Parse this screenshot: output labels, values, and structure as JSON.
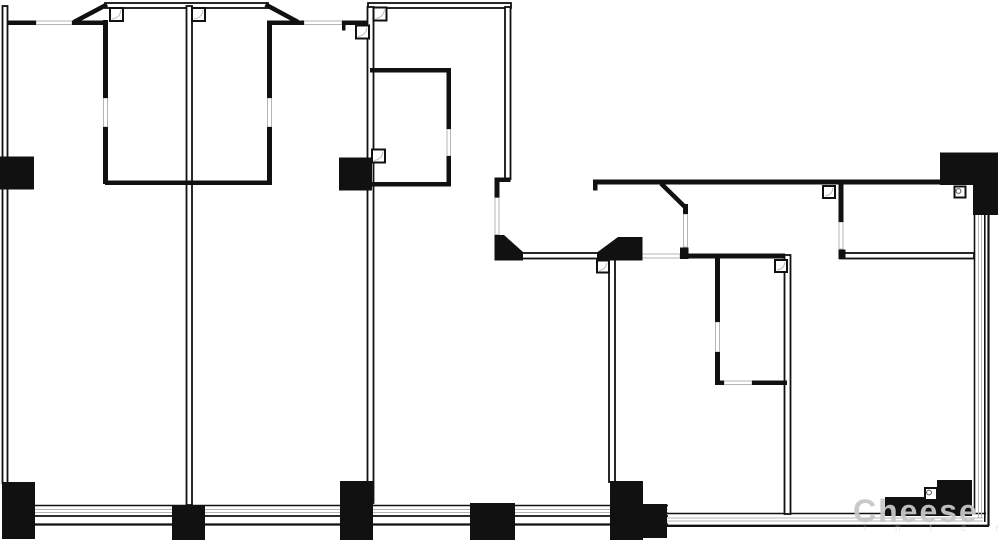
{
  "canvas": {
    "width": 1000,
    "height": 541,
    "background": "#ffffff"
  },
  "colors": {
    "wall": "#111111",
    "wall_core": "#ffffff",
    "opening": "#b5b5b5",
    "swing_arc": "#bbbbbb",
    "watermark": "#c7c7c7",
    "watermark_sub": "#d2d2d2"
  },
  "watermark": {
    "text": "Cheese",
    "sub_text": "i n t e r",
    "x": 853,
    "y": 522,
    "font_size": 32,
    "letter_spacing": 2,
    "opacity": 0.95,
    "sub_x": 864,
    "sub_y": 531,
    "sub_font_size": 10,
    "sub_letter_spacing": 13,
    "sub_opacity": 0.55
  },
  "plan": {
    "bands": [
      {
        "x1": 35,
        "y1": 505.5,
        "x2": 668,
        "y2": 505.5,
        "w": 1.6,
        "c": "wall"
      },
      {
        "x1": 35,
        "y1": 509.5,
        "x2": 668,
        "y2": 509.5,
        "w": 1.0,
        "c": "opening"
      },
      {
        "x1": 35,
        "y1": 512.5,
        "x2": 668,
        "y2": 512.5,
        "w": 1.0,
        "c": "opening"
      },
      {
        "x1": 35,
        "y1": 516.0,
        "x2": 668,
        "y2": 516.0,
        "w": 1.8,
        "c": "wall"
      },
      {
        "x1": 35,
        "y1": 524.5,
        "x2": 668,
        "y2": 524.5,
        "w": 2.2,
        "c": "wall"
      },
      {
        "x1": 667,
        "y1": 513.5,
        "x2": 986,
        "y2": 513.5,
        "w": 1.6,
        "c": "wall"
      },
      {
        "x1": 667,
        "y1": 518.0,
        "x2": 983,
        "y2": 518.0,
        "w": 1.0,
        "c": "opening"
      },
      {
        "x1": 667,
        "y1": 521.0,
        "x2": 983,
        "y2": 521.0,
        "w": 1.0,
        "c": "opening"
      },
      {
        "x1": 667,
        "y1": 525.8,
        "x2": 989,
        "y2": 525.8,
        "w": 2.4,
        "c": "wall"
      },
      {
        "x1": 974.5,
        "y1": 215,
        "x2": 974.5,
        "y2": 513,
        "w": 1.6,
        "c": "wall"
      },
      {
        "x1": 978.5,
        "y1": 215,
        "x2": 978.5,
        "y2": 518,
        "w": 1.0,
        "c": "opening"
      },
      {
        "x1": 981.5,
        "y1": 215,
        "x2": 981.5,
        "y2": 518,
        "w": 1.0,
        "c": "opening"
      },
      {
        "x1": 984.8,
        "y1": 215,
        "x2": 984.8,
        "y2": 522,
        "w": 1.6,
        "c": "wall"
      },
      {
        "x1": 988.5,
        "y1": 215,
        "x2": 988.5,
        "y2": 526,
        "w": 2.2,
        "c": "wall"
      }
    ],
    "hollow_walls": [
      {
        "x": 2.5,
        "y": 6,
        "w": 5,
        "h": 477
      },
      {
        "x": 105,
        "y": 3,
        "w": 163,
        "h": 5
      },
      {
        "x": 368,
        "y": 3,
        "w": 143,
        "h": 5
      },
      {
        "x": 186.5,
        "y": 6,
        "w": 5.5,
        "h": 499
      },
      {
        "x": 367.5,
        "y": 7,
        "w": 6,
        "h": 496
      },
      {
        "x": 505,
        "y": 7,
        "w": 5.5,
        "h": 172
      },
      {
        "x": 522,
        "y": 253,
        "w": 76,
        "h": 5.5
      },
      {
        "x": 609,
        "y": 259,
        "w": 6,
        "h": 223
      },
      {
        "x": 784.5,
        "y": 255,
        "w": 6,
        "h": 259
      },
      {
        "x": 840,
        "y": 253,
        "w": 134,
        "h": 5.5
      }
    ],
    "solid_walls": [
      {
        "x": 103,
        "y": 20,
        "w": 5,
        "h": 78
      },
      {
        "x": 103,
        "y": 127,
        "w": 5,
        "h": 57
      },
      {
        "x": 267,
        "y": 22,
        "w": 5,
        "h": 76
      },
      {
        "x": 267,
        "y": 127,
        "w": 5,
        "h": 58
      },
      {
        "x": 105,
        "y": 180.5,
        "w": 167,
        "h": 4.5
      },
      {
        "x": 7,
        "y": 20.5,
        "w": 29,
        "h": 4.5
      },
      {
        "x": 72,
        "y": 20.5,
        "w": 33,
        "h": 4.5
      },
      {
        "x": 267,
        "y": 20.5,
        "w": 37,
        "h": 4.5
      },
      {
        "x": 342,
        "y": 20.5,
        "w": 26,
        "h": 4.5
      },
      {
        "x": 342,
        "y": 20.5,
        "w": 3.5,
        "h": 10
      },
      {
        "x": 370,
        "y": 68,
        "w": 81,
        "h": 4.5
      },
      {
        "x": 446.5,
        "y": 68,
        "w": 4.5,
        "h": 61
      },
      {
        "x": 446.5,
        "y": 156,
        "w": 4.5,
        "h": 30
      },
      {
        "x": 370,
        "y": 182,
        "w": 81,
        "h": 4.5
      },
      {
        "x": 494.5,
        "y": 177.5,
        "w": 16,
        "h": 4.5
      },
      {
        "x": 494.5,
        "y": 177.5,
        "w": 5,
        "h": 20
      },
      {
        "x": 593,
        "y": 179.5,
        "w": 348,
        "h": 5
      },
      {
        "x": 593,
        "y": 179.5,
        "w": 4.5,
        "h": 11
      },
      {
        "x": 683,
        "y": 204,
        "w": 5,
        "h": 10
      },
      {
        "x": 680,
        "y": 247.5,
        "w": 8.5,
        "h": 11.5
      },
      {
        "x": 688,
        "y": 253.5,
        "w": 97,
        "h": 5
      },
      {
        "x": 838.5,
        "y": 184,
        "w": 5,
        "h": 38
      },
      {
        "x": 838.5,
        "y": 249.5,
        "w": 7,
        "h": 9.5
      },
      {
        "x": 715,
        "y": 258,
        "w": 5,
        "h": 64
      },
      {
        "x": 715,
        "y": 352,
        "w": 5,
        "h": 33
      },
      {
        "x": 715,
        "y": 380.5,
        "w": 9,
        "h": 4.5
      },
      {
        "x": 752,
        "y": 380.5,
        "w": 35,
        "h": 4.5
      }
    ],
    "diagonals": [
      {
        "x1": 74,
        "y1": 22,
        "x2": 107,
        "y2": 4.5,
        "w": 4.5
      },
      {
        "x1": 265.5,
        "y1": 4.5,
        "x2": 298,
        "y2": 22,
        "w": 4.5
      },
      {
        "x1": 661,
        "y1": 183.5,
        "x2": 686,
        "y2": 208,
        "w": 4.5
      }
    ],
    "openings": [
      {
        "x": 36,
        "y": 21,
        "w": 36,
        "h": 3.5
      },
      {
        "x": 304,
        "y": 21,
        "w": 38,
        "h": 3.5
      },
      {
        "x": 103.5,
        "y": 98,
        "w": 4,
        "h": 29
      },
      {
        "x": 267.5,
        "y": 98,
        "w": 4,
        "h": 29
      },
      {
        "x": 447,
        "y": 129,
        "w": 3.5,
        "h": 27
      },
      {
        "x": 495,
        "y": 197.5,
        "w": 4,
        "h": 37
      },
      {
        "x": 642,
        "y": 254,
        "w": 38,
        "h": 4
      },
      {
        "x": 683.5,
        "y": 214,
        "w": 4,
        "h": 33
      },
      {
        "x": 839,
        "y": 222,
        "w": 4,
        "h": 27
      },
      {
        "x": 715.5,
        "y": 322,
        "w": 4,
        "h": 30
      },
      {
        "x": 724,
        "y": 381,
        "w": 28,
        "h": 3.5
      }
    ],
    "columns": [
      {
        "x": 0,
        "y": 156.5,
        "w": 34,
        "h": 33
      },
      {
        "x": 339,
        "y": 157.5,
        "w": 33,
        "h": 33
      },
      {
        "x": 2,
        "y": 482,
        "w": 33,
        "h": 57
      },
      {
        "x": 172,
        "y": 505,
        "w": 33,
        "h": 35
      },
      {
        "x": 340,
        "y": 481,
        "w": 33,
        "h": 59
      },
      {
        "x": 470,
        "y": 503,
        "w": 45,
        "h": 37
      },
      {
        "x": 610,
        "y": 481,
        "w": 33,
        "h": 59
      },
      {
        "x": 643,
        "y": 504,
        "w": 24,
        "h": 34
      },
      {
        "x": 885,
        "y": 497,
        "w": 52,
        "h": 19
      },
      {
        "x": 937,
        "y": 480,
        "w": 35,
        "h": 36
      },
      {
        "x": 940,
        "y": 152.5,
        "w": 33,
        "h": 32.5
      },
      {
        "x": 973,
        "y": 152.5,
        "w": 25,
        "h": 62.5
      }
    ],
    "chamfer_columns": [
      {
        "points": [
          [
            494.5,
            235
          ],
          [
            504,
            235
          ],
          [
            523,
            252
          ],
          [
            523,
            260.5
          ],
          [
            494.5,
            260.5
          ]
        ]
      },
      {
        "points": [
          [
            618,
            237
          ],
          [
            642.5,
            237
          ],
          [
            642.5,
            260.5
          ],
          [
            597,
            260.5
          ],
          [
            597,
            252.5
          ]
        ]
      }
    ],
    "door_squares": [
      {
        "x": 110,
        "y": 8,
        "s": 13,
        "m": "arc"
      },
      {
        "x": 192,
        "y": 8,
        "s": 13,
        "m": "arc"
      },
      {
        "x": 373.5,
        "y": 7.5,
        "s": 13,
        "m": "arc"
      },
      {
        "x": 356,
        "y": 25.5,
        "s": 13,
        "m": "arc"
      },
      {
        "x": 372,
        "y": 149.5,
        "s": 13,
        "m": "arc"
      },
      {
        "x": 597,
        "y": 260.5,
        "s": 12,
        "m": "arc"
      },
      {
        "x": 775,
        "y": 260,
        "s": 12,
        "m": "arc"
      },
      {
        "x": 823,
        "y": 186,
        "s": 12,
        "m": "arc"
      },
      {
        "x": 954.5,
        "y": 186.5,
        "s": 11,
        "m": "circle"
      },
      {
        "x": 925,
        "y": 488,
        "s": 12,
        "m": "circle"
      }
    ]
  }
}
